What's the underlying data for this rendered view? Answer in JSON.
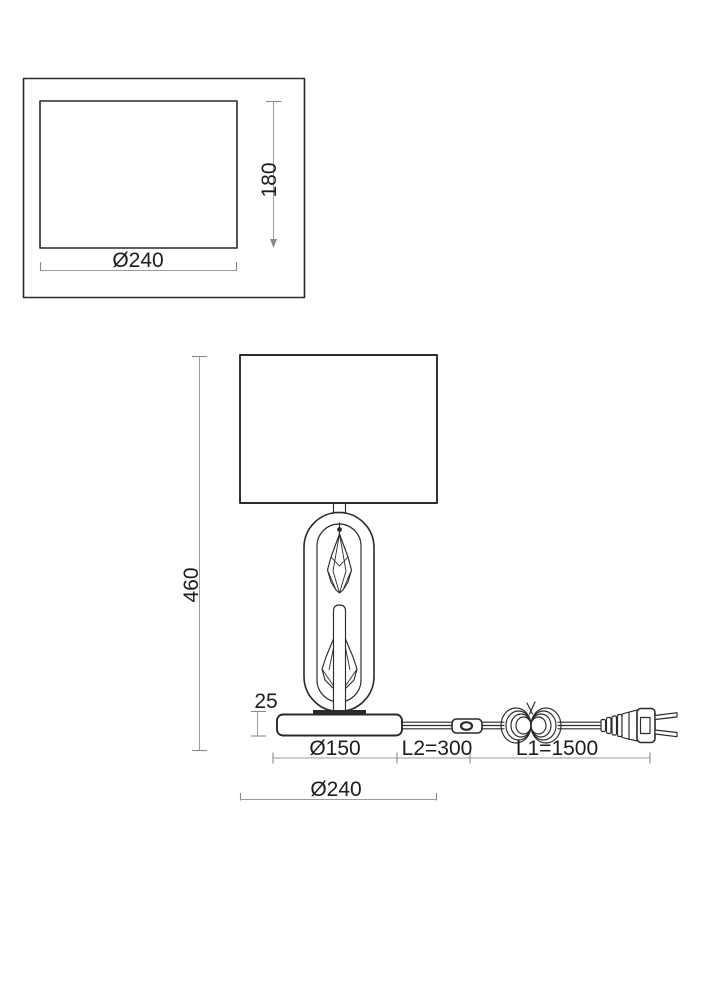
{
  "drawing": {
    "top_view": {
      "width_dim": "Ø240",
      "depth_dim": "180"
    },
    "side_view": {
      "height_dim": "460",
      "base_height_dim": "25",
      "base_width_dim": "Ø150",
      "switch_cord_dim": "L2=300",
      "cord_length_dim": "L1=1500",
      "shade_width_dim": "Ø240"
    },
    "colors": {
      "outline": "#2a2a2a",
      "dimension_line": "#9c9c9c",
      "dimension_text": "#1c1c1c",
      "background": "#ffffff"
    }
  }
}
